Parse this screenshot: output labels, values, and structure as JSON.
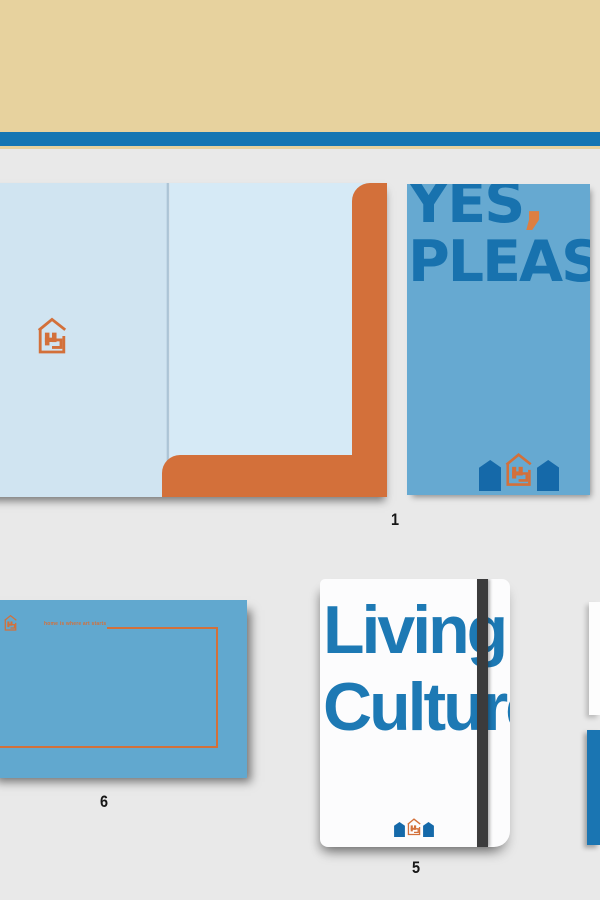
{
  "page": {
    "background_color": "#e9e9e9"
  },
  "header": {
    "band_color": "#e7d29e",
    "stripe_color": "#1576b3"
  },
  "palette": {
    "orange": "#d3703a",
    "headline_blue": "#1872ae",
    "card_blue": "#66a9d1",
    "envelope_blue": "#61a8cf",
    "folder_blue": "#d0e4f1",
    "house_blue": "#1569a9",
    "notebook_title_blue": "#1d79b4",
    "elastic_band_dark": "#3b3b3c"
  },
  "icons": [
    {
      "name": "house-logo-icon",
      "meaning": "outlined house containing letter H (brand mark)"
    },
    {
      "name": "pentagon-house-icon",
      "meaning": "solid blue house silhouette"
    }
  ],
  "top_set": {
    "label": "1"
  },
  "card": {
    "word_yes": "YES",
    "comma": ",",
    "word_please": "PLEASE"
  },
  "envelope": {
    "label": "6",
    "tagline": "home is where art starts"
  },
  "notebook": {
    "label": "5",
    "title_line1": "Living",
    "title_line2": "Culture"
  }
}
